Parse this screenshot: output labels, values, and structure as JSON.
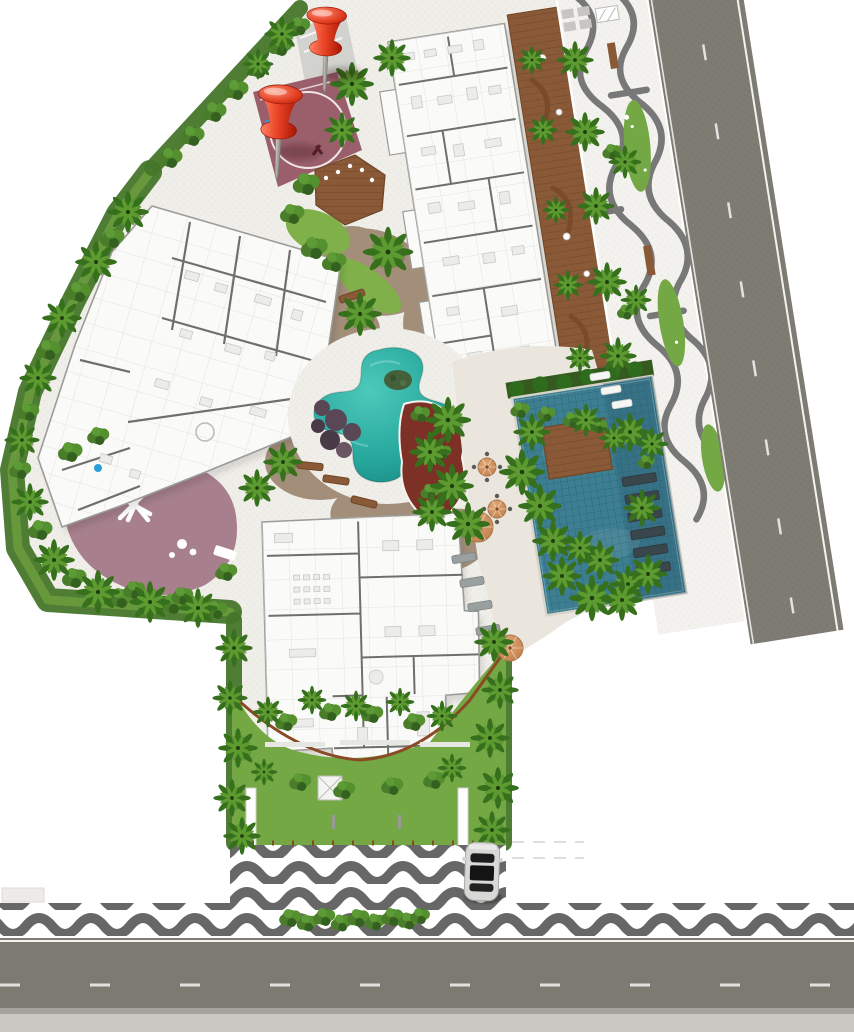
{
  "title": "Residential complex landscaped site plan - aerial top view",
  "palette": {
    "page_bg": "#ffffff",
    "pebble": "#f0eee9",
    "pebble_dot": "#e1ded6",
    "sidewalk": "#f3f2ee",
    "meander_gray": "#6e6e6e",
    "lawn": "#74a844",
    "lawn_dark": "#46762a",
    "hedge": "#35591f",
    "wood": "#8a5a38",
    "wood_dark": "#6f4526",
    "dirt": "#a38e7a",
    "leisure_pool": "#2ab3a8",
    "lap_pool": "#3d7f92",
    "lap_pool_grid": "#2c6273",
    "pool_island": "#44603a",
    "pool_rocks": "#5a4755",
    "court": "#9a5f6b",
    "playground": "#a77f8d",
    "mulch": "#7c3026",
    "road": "#7d7a71",
    "wave_dark": "#676767",
    "curb": "#b9b7b2",
    "building": "#fafaf9",
    "wall": "#6f6f6c",
    "wall_light": "#dddcd8",
    "furniture": "#ececea",
    "stone_deck": "#eae6dd",
    "pin_red": "#e8391d",
    "metal": "#b9b7b0",
    "car_body": "#d8d8d6",
    "car_glass": "#1c1c1c",
    "sign_blue": "#2b9fd8",
    "corten": "#8a4a26"
  },
  "markers": {
    "pushpins": [
      {
        "id": "pin-1",
        "x": 327,
        "y": 8,
        "scale": 0.95,
        "rot": 2
      },
      {
        "id": "pin-2",
        "x": 281,
        "y": 86,
        "scale": 1.05,
        "rot": 3
      }
    ]
  },
  "objects": {
    "car": {
      "x": 466,
      "y": 842,
      "body": "#d8d8d6",
      "glass": "#1c1c1c"
    }
  },
  "areas": [
    {
      "name": "sports-court",
      "color": "#9a5f6b"
    },
    {
      "name": "playground",
      "color": "#a77f8d"
    },
    {
      "name": "leisure-pool",
      "color": "#2ab3a8"
    },
    {
      "name": "lap-pool",
      "color": "#3d7f92"
    },
    {
      "name": "wood-deck",
      "color": "#8a5a38"
    },
    {
      "name": "avenue-right",
      "color": "#7d7a71"
    },
    {
      "name": "avenue-bottom",
      "color": "#7d7a71"
    },
    {
      "name": "copacabana-wave-sidewalk",
      "color": "#676767"
    }
  ],
  "vegetation": {
    "palms": [
      [
        282,
        34,
        0.8
      ],
      [
        258,
        64,
        0.7
      ],
      [
        352,
        84,
        1.0
      ],
      [
        392,
        58,
        0.85
      ],
      [
        342,
        130,
        0.8
      ],
      [
        128,
        212,
        0.95
      ],
      [
        96,
        262,
        0.95
      ],
      [
        62,
        318,
        0.9
      ],
      [
        38,
        378,
        0.85
      ],
      [
        22,
        440,
        0.8
      ],
      [
        30,
        502,
        0.85
      ],
      [
        54,
        560,
        0.95
      ],
      [
        98,
        592,
        1.0
      ],
      [
        150,
        602,
        0.95
      ],
      [
        198,
        608,
        0.9
      ],
      [
        388,
        252,
        1.15
      ],
      [
        360,
        314,
        1.0
      ],
      [
        283,
        462,
        0.9
      ],
      [
        257,
        488,
        0.85
      ],
      [
        448,
        420,
        1.05
      ],
      [
        430,
        452,
        0.95
      ],
      [
        452,
        486,
        1.0
      ],
      [
        432,
        512,
        0.9
      ],
      [
        468,
        524,
        1.0
      ],
      [
        532,
        60,
        0.65
      ],
      [
        543,
        130,
        0.68
      ],
      [
        556,
        210,
        0.62
      ],
      [
        568,
        285,
        0.68
      ],
      [
        580,
        358,
        0.65
      ],
      [
        575,
        60,
        0.85
      ],
      [
        585,
        132,
        0.9
      ],
      [
        596,
        206,
        0.85
      ],
      [
        607,
        282,
        0.9
      ],
      [
        618,
        356,
        0.85
      ],
      [
        630,
        432,
        0.9
      ],
      [
        642,
        508,
        0.85
      ],
      [
        625,
        162,
        0.75
      ],
      [
        636,
        300,
        0.7
      ],
      [
        652,
        444,
        0.75
      ],
      [
        600,
        560,
        0.9
      ],
      [
        628,
        584,
        0.85
      ],
      [
        580,
        548,
        0.8
      ],
      [
        522,
        472,
        1.05
      ],
      [
        540,
        506,
        1.0
      ],
      [
        553,
        541,
        0.95
      ],
      [
        562,
        576,
        0.9
      ],
      [
        592,
        598,
        1.05
      ],
      [
        622,
        600,
        0.95
      ],
      [
        648,
        574,
        0.9
      ],
      [
        532,
        432,
        0.85
      ],
      [
        586,
        420,
        0.75
      ],
      [
        614,
        438,
        0.7
      ],
      [
        234,
        648,
        0.85
      ],
      [
        230,
        698,
        0.8
      ],
      [
        238,
        748,
        0.9
      ],
      [
        232,
        798,
        0.85
      ],
      [
        242,
        836,
        0.85
      ],
      [
        494,
        642,
        0.9
      ],
      [
        500,
        690,
        0.85
      ],
      [
        490,
        738,
        0.9
      ],
      [
        498,
        788,
        0.95
      ],
      [
        492,
        830,
        0.85
      ],
      [
        268,
        712,
        0.7
      ],
      [
        312,
        700,
        0.65
      ],
      [
        356,
        706,
        0.7
      ],
      [
        400,
        702,
        0.65
      ],
      [
        442,
        716,
        0.7
      ],
      [
        264,
        772,
        0.6
      ],
      [
        452,
        768,
        0.65
      ]
    ],
    "bushes": [
      [
        170,
        158,
        1
      ],
      [
        192,
        136,
        1
      ],
      [
        214,
        112,
        1
      ],
      [
        236,
        90,
        1
      ],
      [
        258,
        68,
        1
      ],
      [
        280,
        46,
        1
      ],
      [
        299,
        26,
        0.9
      ],
      [
        306,
        184,
        1.1
      ],
      [
        292,
        214,
        1
      ],
      [
        314,
        248,
        1.1
      ],
      [
        334,
        262,
        1
      ],
      [
        112,
        238,
        1
      ],
      [
        78,
        292,
        1
      ],
      [
        48,
        350,
        1
      ],
      [
        28,
        412,
        0.9
      ],
      [
        20,
        470,
        0.9
      ],
      [
        40,
        530,
        1
      ],
      [
        74,
        578,
        1
      ],
      [
        120,
        598,
        1
      ],
      [
        172,
        604,
        1
      ],
      [
        216,
        610,
        0.9
      ],
      [
        70,
        452,
        1
      ],
      [
        98,
        436,
        0.9
      ],
      [
        226,
        572,
        0.9
      ],
      [
        182,
        596,
        0.9
      ],
      [
        134,
        590,
        0.9
      ],
      [
        286,
        722,
        0.9
      ],
      [
        330,
        712,
        0.9
      ],
      [
        372,
        714,
        0.9
      ],
      [
        414,
        722,
        0.9
      ],
      [
        300,
        782,
        0.9
      ],
      [
        344,
        790,
        0.9
      ],
      [
        392,
        786,
        0.9
      ],
      [
        434,
        780,
        0.9
      ],
      [
        290,
        918,
        0.9
      ],
      [
        307,
        923,
        0.85
      ],
      [
        324,
        917,
        0.9
      ],
      [
        341,
        923,
        0.85
      ],
      [
        358,
        918,
        0.9
      ],
      [
        375,
        922,
        0.85
      ],
      [
        392,
        917,
        0.9
      ],
      [
        408,
        921,
        0.85
      ],
      [
        420,
        916,
        0.8
      ],
      [
        612,
        152,
        0.8
      ],
      [
        626,
        312,
        0.75
      ],
      [
        646,
        462,
        0.7
      ],
      [
        420,
        414,
        0.8
      ],
      [
        442,
        452,
        0.75
      ],
      [
        430,
        492,
        0.8
      ],
      [
        520,
        410,
        0.8
      ],
      [
        546,
        414,
        0.75
      ],
      [
        572,
        420,
        0.8
      ],
      [
        598,
        426,
        0.75
      ]
    ]
  },
  "furniture": {
    "benches": [
      [
        352,
        296,
        -18
      ],
      [
        310,
        466,
        6
      ],
      [
        336,
        480,
        8
      ],
      [
        364,
        502,
        14
      ]
    ],
    "umbrellas": [
      [
        487,
        467,
        9
      ],
      [
        497,
        509,
        9
      ],
      [
        478,
        527,
        15
      ],
      [
        510,
        648,
        13
      ]
    ],
    "gray_loungers": [
      [
        464,
        558
      ],
      [
        472,
        582
      ],
      [
        480,
        606
      ],
      [
        488,
        630
      ]
    ],
    "white_loungers": [
      [
        600,
        376
      ],
      [
        611,
        390
      ],
      [
        622,
        404
      ]
    ],
    "in_pool_loungers_count": 6
  }
}
